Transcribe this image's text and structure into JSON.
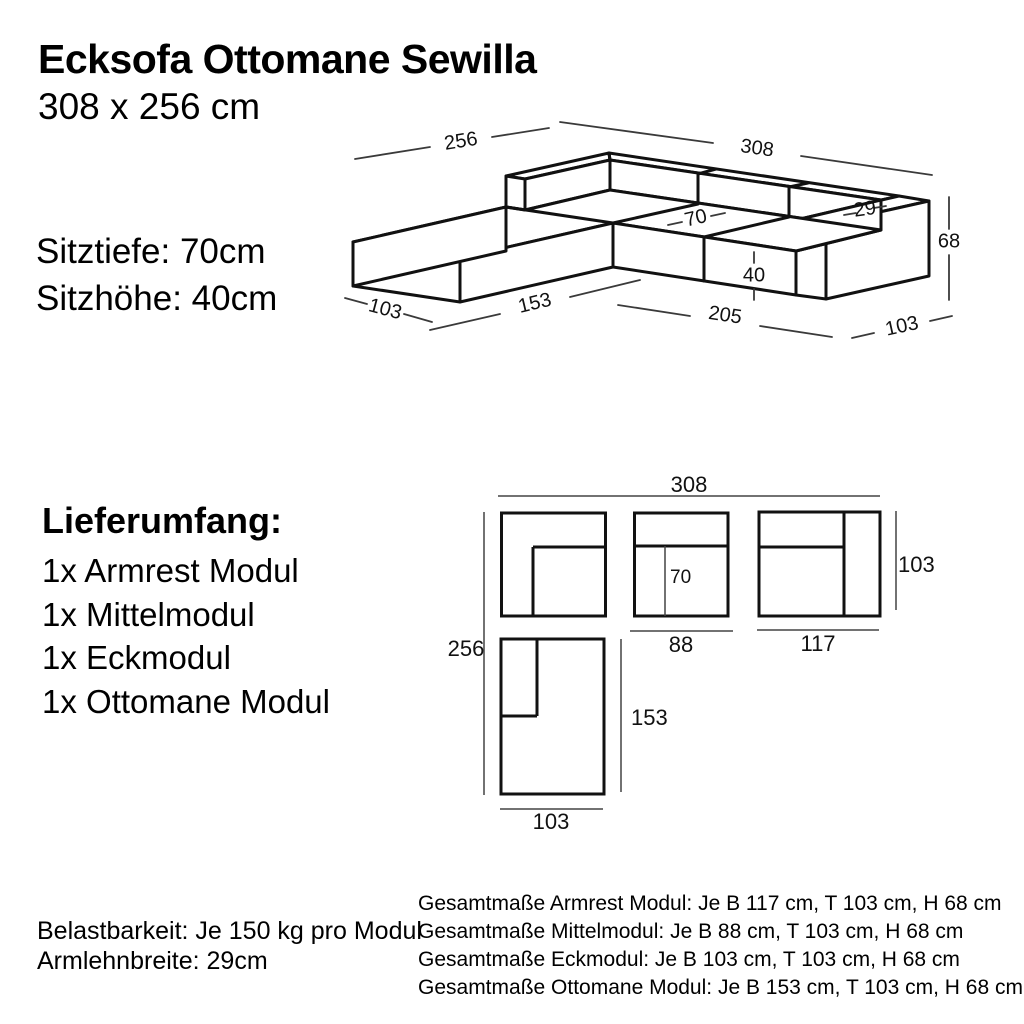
{
  "header": {
    "title": "Ecksofa Ottomane Sewilla",
    "subtitle": "308 x 256 cm"
  },
  "specs": {
    "seat_depth": "Sitztiefe: 70cm",
    "seat_height": "Sitzhöhe: 40cm"
  },
  "delivery": {
    "heading": "Lieferumfang:",
    "items": [
      "1x Armrest Modul",
      "1x Mittelmodul",
      "1x Eckmodul",
      "1x Ottomane Modul"
    ]
  },
  "footer_left": {
    "load": "Belastbarkeit: Je 150 kg pro Modul",
    "armrest": "Armlehnbreite: 29cm"
  },
  "footer_right": {
    "lines": [
      "Gesamtmaße Armrest Modul: Je B 117 cm, T 103 cm, H 68 cm",
      "Gesamtmaße Mittelmodul: Je B 88 cm, T 103 cm, H 68 cm",
      "Gesamtmaße Eckmodul: Je B 103 cm, T 103 cm, H 68 cm",
      "Gesamtmaße Ottomane Modul: Je B 153 cm, T 103 cm, H 68 cm"
    ]
  },
  "iso_dims": {
    "back_width": "308",
    "left_depth": "256",
    "seat_depth": "70",
    "armrest_top_width": "29",
    "total_height": "68",
    "seat_height": "40",
    "front_width": "205",
    "ottomane_edge": "153",
    "ottomane_front_width": "103",
    "right_depth": "103"
  },
  "plan_dims": {
    "total_width": "308",
    "total_depth": "256",
    "seat_depth": "70",
    "middle_module_width": "88",
    "armrest_module_width": "117",
    "module_depth": "103",
    "ottomane_length": "153",
    "ottomane_width": "103"
  },
  "colors": {
    "line": "#111111",
    "dim_line": "#3a3a3a",
    "text": "#000000"
  }
}
